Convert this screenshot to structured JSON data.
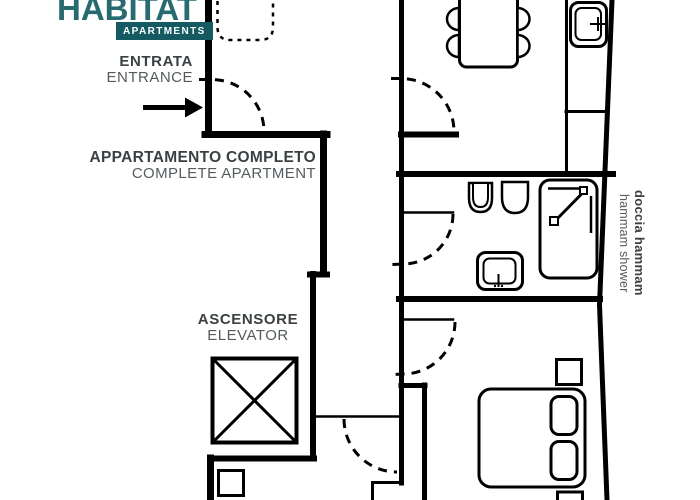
{
  "logo": {
    "brand": "HABITAT",
    "badge": "APARTMENTS"
  },
  "annotations": {
    "entrance": {
      "title": "ENTRATA",
      "subtitle": "ENTRANCE",
      "icon": "arrow-right"
    },
    "apartment": {
      "title": "APPARTAMENTO COMPLETO",
      "subtitle": "COMPLETE APARTMENT"
    },
    "elevator": {
      "title": "ASCENSORE",
      "subtitle": "ELEVATOR"
    },
    "hammam": {
      "title": "doccia hammam",
      "subtitle": "hammam shower"
    }
  },
  "colors": {
    "brand_teal": "#276b70",
    "badge_bg": "#155a62",
    "title_text": "#3b4043",
    "subtitle_text": "#565b5e",
    "line": "#000000"
  },
  "floorplan": {
    "elements": [
      "entrance-door-arc",
      "kitchen-door-arc",
      "bathroom-door-arc",
      "bedroom-door-arc",
      "hall-door-arc",
      "dining-table",
      "chairs",
      "kitchen-counter",
      "kitchen-sink",
      "toilet",
      "bidet",
      "hammam-shower-cabin",
      "washbasin",
      "double-bed",
      "pillows",
      "nightstands",
      "elevator-cabin",
      "entry-mat"
    ]
  }
}
